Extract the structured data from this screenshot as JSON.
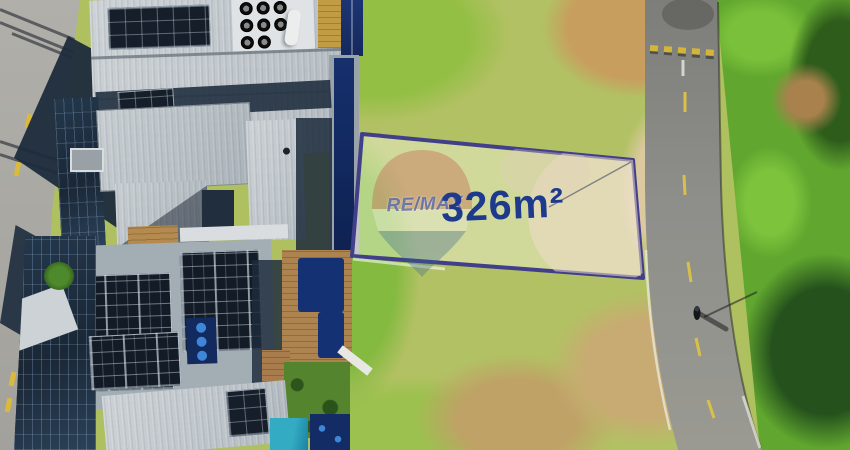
{
  "scene": {
    "type": "aerial-drone-photo",
    "description": "Aerial drone photo of a 326 m2 land plot for sale outlined in dark blue, between modern houses with rooftop solar panels and pools on the left and a curved asphalt road with green roadside vegetation on the right."
  },
  "plot": {
    "area_label": "326m²",
    "border_color": "#413f8a",
    "label_color": "#1d3a8c",
    "highlight_overlay": "rgba(250,250,232,0.42)"
  },
  "watermark": {
    "brand": "RE/MAX",
    "balloon_red": "#c24a40",
    "balloon_white": "#f4f1e6",
    "balloon_blue": "#35608f",
    "opacity": "0.32"
  },
  "environment": {
    "road_color": "#8b8b87",
    "road_marking_yellow": "#d8b83a",
    "grass_light": "#b2c163",
    "grass_bright": "#93bf44",
    "vegetation_green": "#61a72f",
    "tree_dark": "#24511c",
    "dirt_tan": "#c89e5e",
    "roof_gray": "#c7cdd1",
    "solar_panel_dark": "#151e29",
    "pool_navy": "#16306d",
    "pool_turquoise": "#33abc2",
    "deck_wood": "#ad8350",
    "street_gray": "#a6a5a0",
    "building_shadow": "#1d2b3c"
  }
}
